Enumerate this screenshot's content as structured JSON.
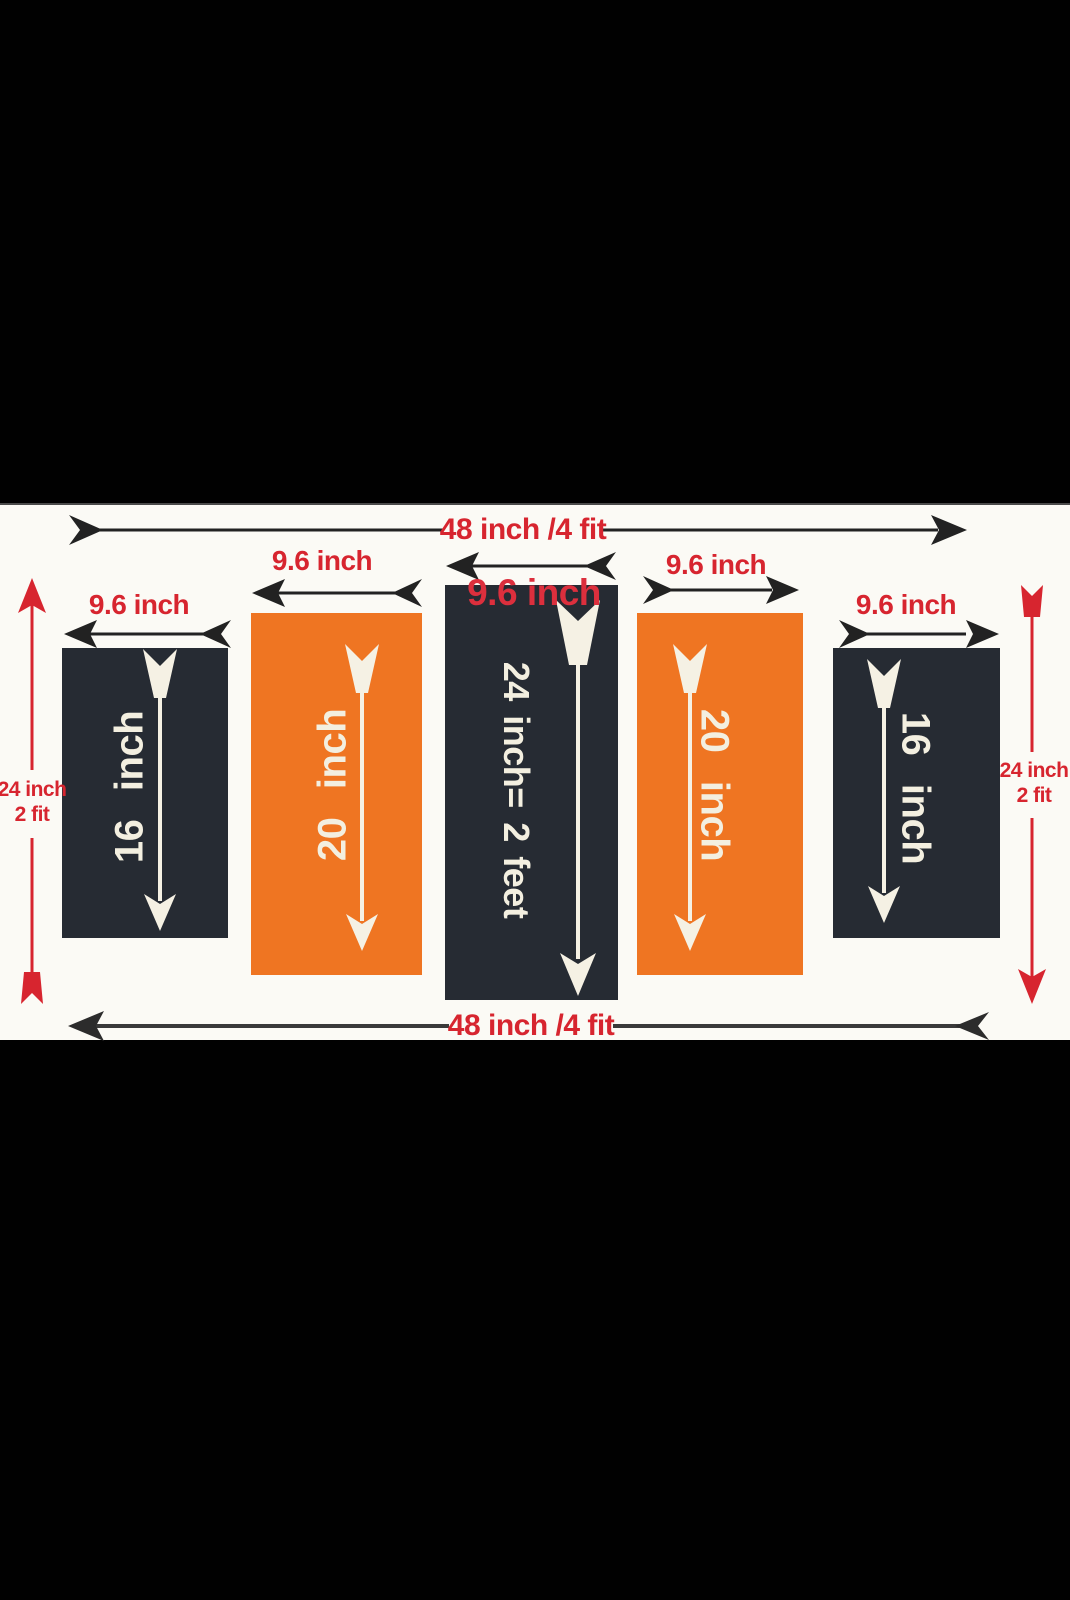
{
  "diagram": {
    "top_width_label": "48 inch /4 fit",
    "bottom_width_label": "48 inch /4 fit",
    "left_height_label": {
      "line1": "24 inch",
      "line2": "2 fit"
    },
    "right_height_label": {
      "line1": "24 inch",
      "line2": "2 fit"
    },
    "panels": [
      {
        "position": "far-left",
        "fill": "#262b33",
        "width_label": "9.6 inch",
        "length_label": "16 inch",
        "text_reads": "bottom-to-top"
      },
      {
        "position": "mid-left",
        "fill": "#ef7522",
        "width_label": "9.6 inch",
        "length_label": "20 inch",
        "text_reads": "bottom-to-top"
      },
      {
        "position": "center",
        "fill": "#262b33",
        "width_label": "9.6 inch",
        "length_label": "24 inch= 2 feet",
        "text_reads": "top-to-bottom"
      },
      {
        "position": "mid-right",
        "fill": "#ef7522",
        "width_label": "9.6 inch",
        "length_label": "20 inch",
        "text_reads": "top-to-bottom"
      },
      {
        "position": "far-right",
        "fill": "#262b33",
        "width_label": "9.6 inch",
        "length_label": "16 inch",
        "text_reads": "top-to-bottom"
      }
    ],
    "colors": {
      "background_band": "#010101",
      "canvas": "#fbfaf5",
      "dark_panel": "#262b33",
      "orange_panel": "#ef7522",
      "red_label": "#d7252f",
      "black_arrow": "#222222",
      "white_arrow": "#f5f1e4"
    }
  }
}
